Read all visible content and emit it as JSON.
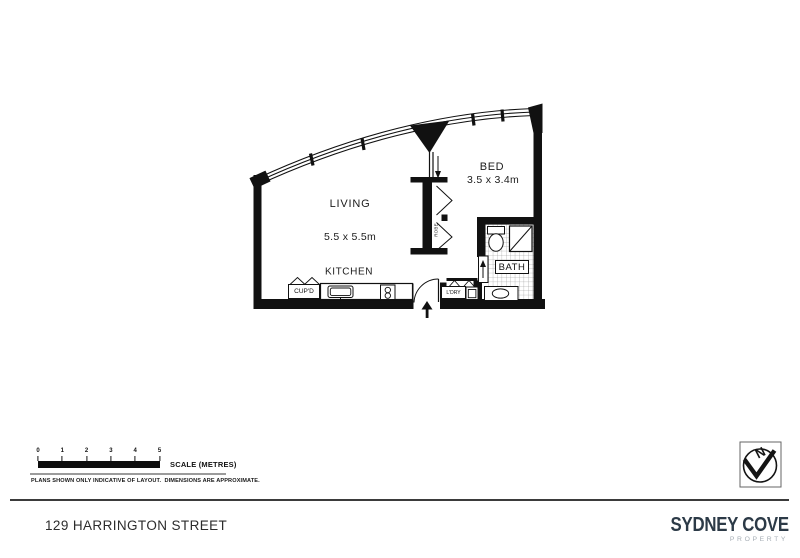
{
  "plan": {
    "living": {
      "name": "LIVING",
      "dims": "5.5 x 5.5m"
    },
    "bed": {
      "name": "BED",
      "dims": "3.5 x 3.4m"
    },
    "kitchen": {
      "name": "KITCHEN"
    },
    "bath": {
      "name": "BATH"
    },
    "cupboard": {
      "name": "CUP'D"
    },
    "laundry": {
      "name": "L'DRY"
    },
    "robe": {
      "name": "ROBE"
    }
  },
  "scale_bar": {
    "ticks": [
      "0",
      "1",
      "2",
      "3",
      "4",
      "5"
    ],
    "label": "SCALE (METRES)",
    "disclaimer": "PLANS SHOWN ONLY INDICATIVE OF LAYOUT.  DIMENSIONS ARE APPROXIMATE."
  },
  "compass": {
    "north": "N"
  },
  "footer": {
    "address": "129 HARRINGTON STREET",
    "brand": {
      "name": "SYDNEY COVE",
      "tagline": "PROPERTY"
    }
  },
  "colors": {
    "ink": "#111111",
    "brand_navy": "#2c3a47",
    "brand_gray": "#a6aeb5",
    "scale_line_gray": "#9b9b9b"
  }
}
